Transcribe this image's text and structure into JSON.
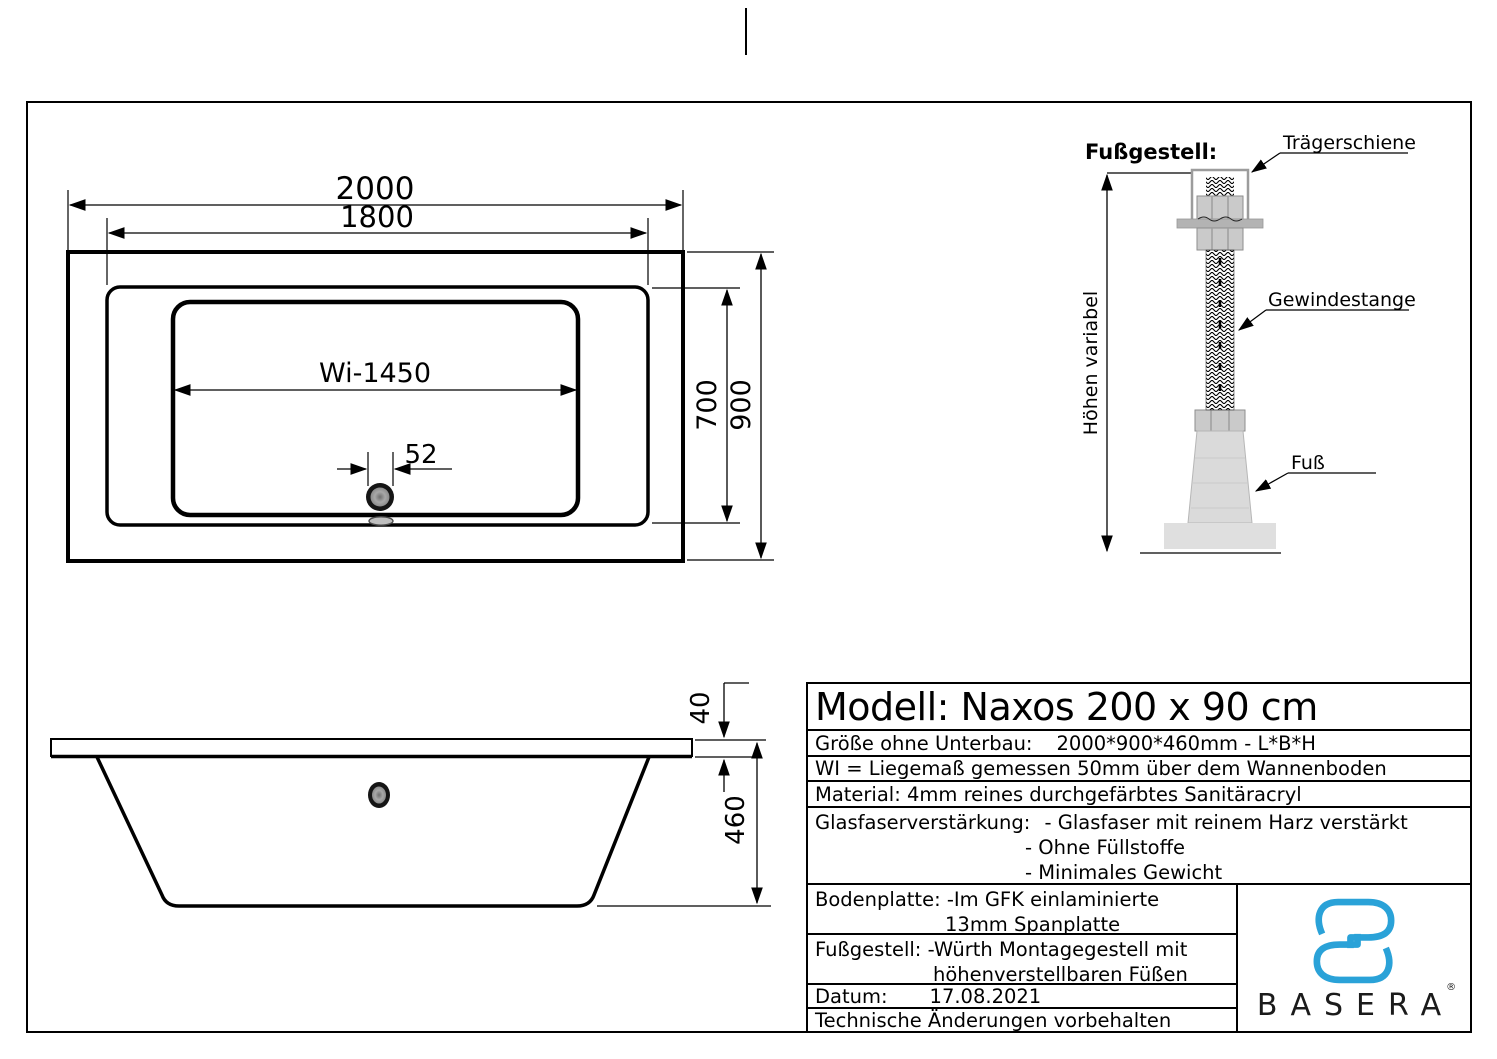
{
  "top_view": {
    "dim_overall_length": "2000",
    "dim_rim_length": "1800",
    "dim_lying_length": "Wi-1450",
    "dim_drain_offset": "52",
    "dim_inner_width": "700",
    "dim_overall_width": "900"
  },
  "side_view": {
    "dim_rim_height": "40",
    "dim_total_height": "460"
  },
  "foot_detail": {
    "title": "Fußgestell:",
    "label_rail": "Trägerschiene",
    "label_rod": "Gewindestange",
    "label_foot": "Fuß",
    "label_height": "Höhen variabel"
  },
  "spec_table": {
    "model_title": "Modell: Naxos 200 x 90 cm",
    "size_label": "Größe ohne Unterbau:",
    "size_value": "2000*900*460mm  -  L*B*H",
    "wi_note": "WI = Liegemaß gemessen 50mm über dem Wannenboden",
    "material": "Material: 4mm reines durchgefärbtes Sanitäracryl",
    "gfk_label": "Glasfaserverstärkung:",
    "gfk_item_1": "- Glasfaser mit reinem Harz verstärkt",
    "gfk_item_2": "- Ohne Füllstoffe",
    "gfk_item_3": "- Minimales Gewicht",
    "bodenplatte_line_1": "Bodenplatte: -Im GFK einlaminierte",
    "bodenplatte_line_2": "13mm Spanplatte",
    "fussgestell_line_1": "Fußgestell: -Würth Montagegestell mit",
    "fussgestell_line_2": "höhenverstellbaren Füßen",
    "date_label": "Datum:",
    "date_value": "17.08.2021",
    "footer_note": "Technische Änderungen vorbehalten"
  },
  "brand": {
    "name": "BASERA",
    "registered_mark": "®",
    "logo_color": "#2aa2d8"
  }
}
